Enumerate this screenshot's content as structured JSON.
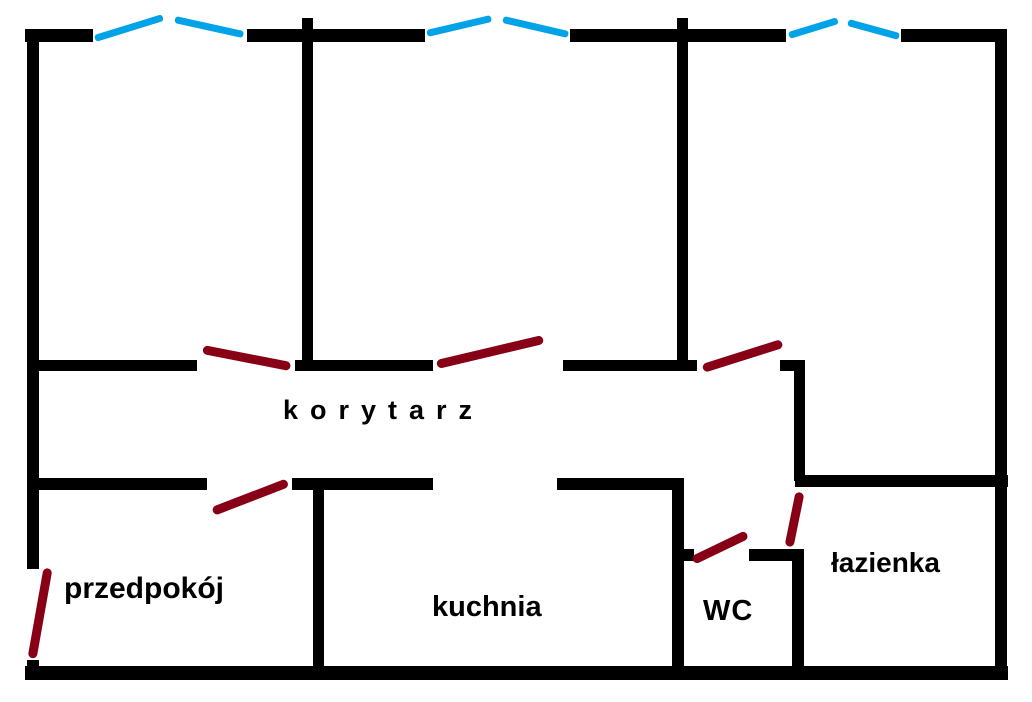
{
  "canvas": {
    "width": 1032,
    "height": 702,
    "background": "#ffffff"
  },
  "palette": {
    "wall": "#000000",
    "window": "#00A2E8",
    "door": "#880015",
    "label": "#000000"
  },
  "room_labels": {
    "korytarz": {
      "text": "korytarz",
      "x": 283,
      "y": 396,
      "font_size": 27,
      "letter_spacing": 12
    },
    "przedpokoj": {
      "text": "przedpokój",
      "x": 64,
      "y": 572,
      "font_size": 30,
      "letter_spacing": 0
    },
    "kuchnia": {
      "text": "kuchnia",
      "x": 432,
      "y": 592,
      "font_size": 29,
      "letter_spacing": 0
    },
    "wc": {
      "text": "WC",
      "x": 703,
      "y": 596,
      "font_size": 29,
      "letter_spacing": 1
    },
    "lazienka": {
      "text": "łazienka",
      "x": 831,
      "y": 548,
      "font_size": 28,
      "letter_spacing": 0
    }
  },
  "walls": [
    {
      "name": "top-wall-segment-1",
      "x": 25,
      "y": 29,
      "w": 68,
      "h": 13
    },
    {
      "name": "top-wall-segment-2",
      "x": 247,
      "y": 29,
      "w": 178,
      "h": 13
    },
    {
      "name": "top-wall-segment-3",
      "x": 570,
      "y": 29,
      "w": 216,
      "h": 13
    },
    {
      "name": "top-wall-segment-4",
      "x": 901,
      "y": 29,
      "w": 103,
      "h": 13
    },
    {
      "name": "left-wall-upper",
      "x": 27,
      "y": 29,
      "w": 12,
      "h": 540
    },
    {
      "name": "left-wall-lower-stub",
      "x": 27,
      "y": 660,
      "w": 12,
      "h": 20
    },
    {
      "name": "right-wall",
      "x": 995,
      "y": 29,
      "w": 12,
      "h": 651
    },
    {
      "name": "bottom-wall",
      "x": 25,
      "y": 666,
      "w": 983,
      "h": 14
    },
    {
      "name": "divider-room1-room2",
      "x": 302,
      "y": 18,
      "w": 11,
      "h": 353
    },
    {
      "name": "divider-room2-room3",
      "x": 677,
      "y": 18,
      "w": 11,
      "h": 353
    },
    {
      "name": "corridor-top-wall-1",
      "x": 27,
      "y": 360,
      "w": 170,
      "h": 11
    },
    {
      "name": "corridor-top-wall-2",
      "x": 295,
      "y": 360,
      "w": 138,
      "h": 11
    },
    {
      "name": "corridor-top-wall-3",
      "x": 563,
      "y": 360,
      "w": 134,
      "h": 11
    },
    {
      "name": "corridor-top-wall-stub",
      "x": 780,
      "y": 360,
      "w": 25,
      "h": 11
    },
    {
      "name": "corridor-bottom-wall-1",
      "x": 27,
      "y": 478,
      "w": 180,
      "h": 12
    },
    {
      "name": "corridor-bottom-wall-2",
      "x": 292,
      "y": 478,
      "w": 141,
      "h": 12
    },
    {
      "name": "corridor-bottom-wall-3",
      "x": 557,
      "y": 478,
      "w": 127,
      "h": 12
    },
    {
      "name": "corridor-bottom-wall-4",
      "x": 795,
      "y": 475,
      "w": 213,
      "h": 12
    },
    {
      "name": "lazienka-corridor-wall",
      "x": 794,
      "y": 360,
      "w": 11,
      "h": 121
    },
    {
      "name": "przedpokoj-kuchnia-wall",
      "x": 313,
      "y": 480,
      "w": 11,
      "h": 190
    },
    {
      "name": "kuchnia-wc-wall",
      "x": 672,
      "y": 480,
      "w": 12,
      "h": 190
    },
    {
      "name": "wc-top-wall-left-stub",
      "x": 678,
      "y": 549,
      "w": 16,
      "h": 12
    },
    {
      "name": "wc-top-wall-right",
      "x": 749,
      "y": 549,
      "w": 55,
      "h": 12
    },
    {
      "name": "wc-lazienka-wall",
      "x": 792,
      "y": 549,
      "w": 12,
      "h": 121
    }
  ],
  "windows": [
    {
      "name": "window-room1-left-pane",
      "x1": 95,
      "y1": 38,
      "x2": 163,
      "y2": 17
    },
    {
      "name": "window-room1-right-pane",
      "x1": 175,
      "y1": 19,
      "x2": 243,
      "y2": 34
    },
    {
      "name": "window-room2-left-pane",
      "x1": 427,
      "y1": 33,
      "x2": 491,
      "y2": 18
    },
    {
      "name": "window-room2-right-pane",
      "x1": 503,
      "y1": 19,
      "x2": 568,
      "y2": 34
    },
    {
      "name": "window-room3-left-pane",
      "x1": 789,
      "y1": 35,
      "x2": 838,
      "y2": 20
    },
    {
      "name": "window-room3-right-pane",
      "x1": 848,
      "y1": 22,
      "x2": 899,
      "y2": 36
    }
  ],
  "doors": [
    {
      "name": "door-room1",
      "x1": 203,
      "y1": 349,
      "x2": 290,
      "y2": 366
    },
    {
      "name": "door-room2",
      "x1": 437,
      "y1": 364,
      "x2": 543,
      "y2": 339
    },
    {
      "name": "door-room3",
      "x1": 703,
      "y1": 368,
      "x2": 782,
      "y2": 343
    },
    {
      "name": "door-przedpokoj",
      "x1": 213,
      "y1": 511,
      "x2": 288,
      "y2": 482
    },
    {
      "name": "door-entrance",
      "x1": 48,
      "y1": 568,
      "x2": 32,
      "y2": 658
    },
    {
      "name": "door-wc",
      "x1": 693,
      "y1": 560,
      "x2": 747,
      "y2": 534
    },
    {
      "name": "door-lazienka",
      "x1": 800,
      "y1": 492,
      "x2": 789,
      "y2": 546
    }
  ]
}
